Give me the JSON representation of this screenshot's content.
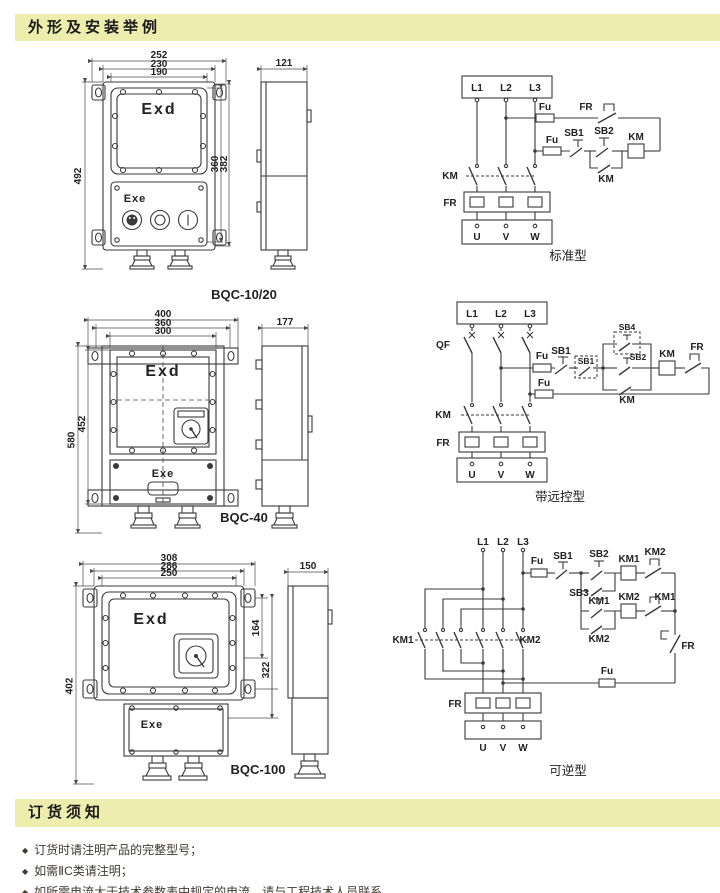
{
  "header": {
    "title": "外形及安装举例"
  },
  "footer_section": {
    "title": "订货须知",
    "bullet": "◆",
    "notes": [
      "订货时请注明产品的完整型号；",
      "如需ⅡC类请注明；",
      "如所需电流大于技术参数表中规定的电流，请与工程技术人员联系。"
    ]
  },
  "outline_figures": [
    {
      "caption": "BQC-10/20",
      "front_marking_top": "Exd",
      "front_marking_bottom": "Exe",
      "dim_top": [
        "252",
        "230",
        "190"
      ],
      "dim_left": "492",
      "dim_right": [
        "360",
        "382"
      ],
      "dim_side": "121"
    },
    {
      "caption": "BQC-40",
      "front_marking_top": "Exd",
      "front_marking_bottom": "Exe",
      "dim_top": [
        "400",
        "360",
        "300"
      ],
      "dim_left": [
        "580",
        "452"
      ],
      "dim_side": "177"
    },
    {
      "caption": "BQC-100",
      "front_marking_top": "Exd",
      "front_marking_bottom": "Exe",
      "dim_top": [
        "308",
        "286",
        "250"
      ],
      "dim_left": "402",
      "dim_right": [
        "164",
        "322"
      ],
      "dim_side": "150"
    }
  ],
  "circuits": [
    {
      "caption": "标准型",
      "labels": {
        "l1": "L1",
        "l2": "L2",
        "l3": "L3",
        "fu1": "Fu",
        "fu2": "Fu",
        "fr_contact": "FR",
        "sb1": "SB1",
        "sb2": "SB2",
        "km_aux": "KM",
        "km_coil": "KM",
        "km_main": "KM",
        "fr": "FR",
        "u": "U",
        "v": "V",
        "w": "W"
      }
    },
    {
      "caption": "带远控型",
      "labels": {
        "l1": "L1",
        "l2": "L2",
        "l3": "L3",
        "qf": "QF",
        "fu1": "Fu",
        "fu2": "Fu",
        "sb1": "SB1",
        "sb1_remote": "SB1",
        "sb4": "SB4",
        "sb2": "SB2",
        "km_aux": "KM",
        "km_coil": "KM",
        "fr_contact": "FR",
        "km_main": "KM",
        "fr": "FR",
        "u": "U",
        "v": "V",
        "w": "W"
      }
    },
    {
      "caption": "可逆型",
      "labels": {
        "l1": "L1",
        "l2": "L2",
        "l3": "L3",
        "fu1": "Fu",
        "fu2": "Fu",
        "sb1": "SB1",
        "sb2": "SB2",
        "sb3": "SB3",
        "km1_aux": "KM1",
        "km2_aux": "KM2",
        "km1_coil": "KM1",
        "km2_coil": "KM2",
        "km2_nc": "KM2",
        "km1_nc": "KM1",
        "km1_main": "KM1",
        "km2_main": "KM2",
        "fr_contact": "FR",
        "fr": "FR",
        "u": "U",
        "v": "V",
        "w": "W"
      }
    }
  ]
}
